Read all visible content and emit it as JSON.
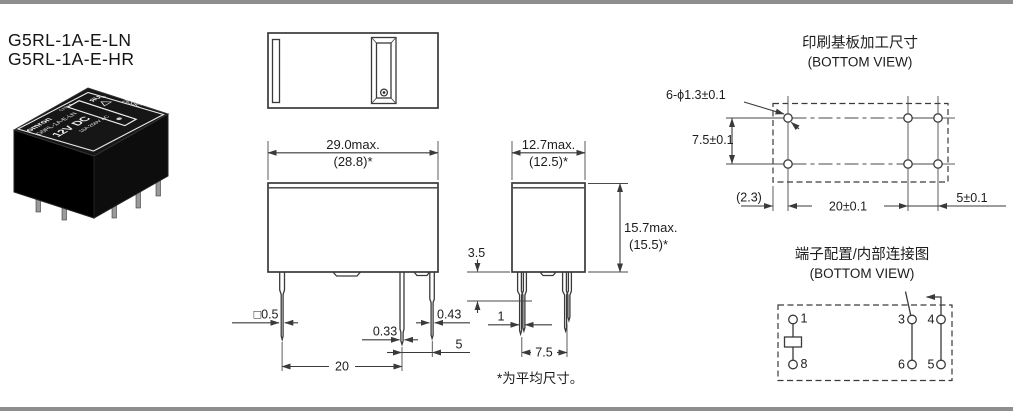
{
  "header": {
    "model_line1": "G5RL-1A-E-LN",
    "model_line2": "G5RL-1A-E-HR"
  },
  "photo": {
    "brand": "omron",
    "origin": "CHINA",
    "model": "G5RL-1A-E-LN",
    "coil_rating": "12V DC",
    "contact_rating": "16A 250V AC",
    "ul_mark": "ЯU",
    "ul_sub": "us",
    "date_code": "26X8C"
  },
  "front_view": {
    "width_max": "29.0max.",
    "width_avg": "(28.8)*",
    "pin_square": "□0.5",
    "pin_mid": "0.33",
    "pin_right": "0.43",
    "pitch_right": "5",
    "pitch_main": "20"
  },
  "side_view": {
    "depth_max": "12.7max.",
    "depth_avg": "(12.5)*",
    "height_max": "15.7max.",
    "height_avg": "(15.5)*",
    "standoff": "3.5",
    "pin_thickness": "1",
    "pin_pitch": "7.5"
  },
  "footnote": "*为平均尺寸。",
  "pcb": {
    "title": "印刷基板加工尺寸",
    "subtitle": "(BOTTOM VIEW)",
    "holes": "6-ϕ1.3±0.1",
    "row_pitch": "7.5±0.1",
    "edge_offset": "(2.3)",
    "col_pitch": "20±0.1",
    "col_pitch2": "5±0.1"
  },
  "terminal": {
    "title": "端子配置/内部连接图",
    "subtitle": "(BOTTOM VIEW)",
    "pin1": "1",
    "pin8": "8",
    "pin3": "3",
    "pin4": "4",
    "pin6": "6",
    "pin5": "5"
  }
}
